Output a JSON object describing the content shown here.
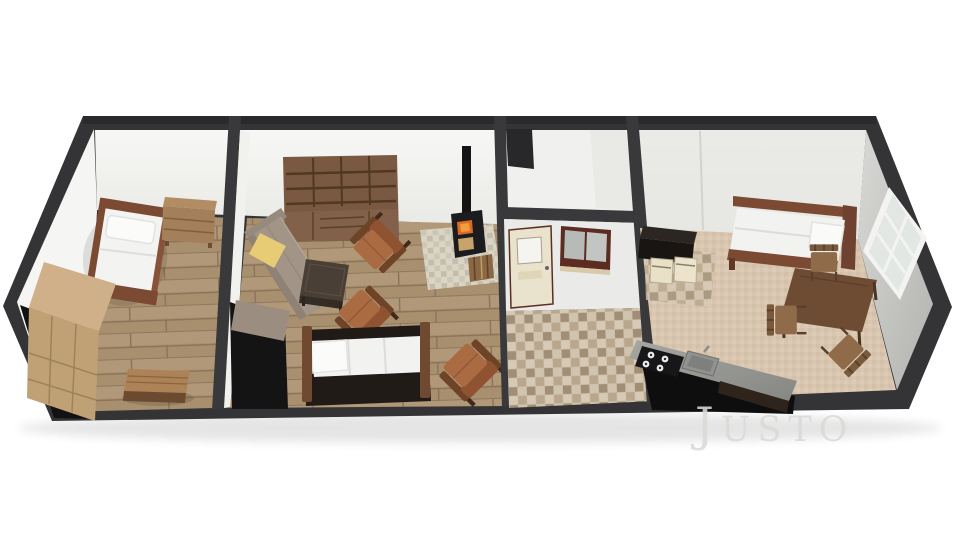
{
  "watermark": {
    "initial": "J",
    "rest": "USTO",
    "text": "Justo"
  },
  "scene": {
    "type": "3d-floorplan-cutaway-render",
    "description": "Long rectangular apartment shown in tilted top-down 3D cutaway with dark wall tops",
    "rooms": [
      {
        "id": "bedroom-left",
        "floor": "wood-planks",
        "furniture": [
          "single-bed",
          "dresser",
          "wardrobe",
          "bench-table"
        ]
      },
      {
        "id": "living-room",
        "floor": "wood-planks",
        "furniture": [
          "bookshelf",
          "corner-sofa",
          "yellow-cushion",
          "coffee-table",
          "armchair-1",
          "armchair-2",
          "armchair-3",
          "daybed",
          "wood-stove",
          "stove-chimney",
          "tile-hearth",
          "firewood-basket"
        ]
      },
      {
        "id": "entry-hall",
        "floor": "mosaic-tile",
        "features": [
          "vestibule",
          "entry-door",
          "interior-window"
        ]
      },
      {
        "id": "kitchen-dining",
        "floor": "carpet",
        "furniture": [
          "kitchenette-cabinet",
          "mini-appliance-1",
          "mini-appliance-2",
          "double-bed",
          "dining-table",
          "dining-chair-1",
          "dining-chair-2",
          "dining-chair-3",
          "kitchen-counter",
          "gas-hob",
          "kitchen-sink",
          "wall-window"
        ]
      }
    ],
    "palette": {
      "background": "#ffffff",
      "wall_top_band": "#39393b",
      "wall_white": "#f2f2f0",
      "wall_gray": "#c5c6c2",
      "wood_floor": "#a8906f",
      "tile_floor": "#cabba2",
      "carpet": "#d9c6b0",
      "bookshelf_wood": "#7a5942",
      "sofa_taupe": "#a29588",
      "cushion_yellow": "#e8cb75",
      "armchair_cognac": "#aa6a42",
      "bed_frame_brown": "#7c4a33",
      "stove_black": "#1c1c1e",
      "fire_orange": "#d86b28",
      "door_cream": "#e9e2cc",
      "window_frame_red": "#5c2b21",
      "counter_gray": "#9b9b97",
      "watermark_gray": "#dcdad6"
    }
  }
}
